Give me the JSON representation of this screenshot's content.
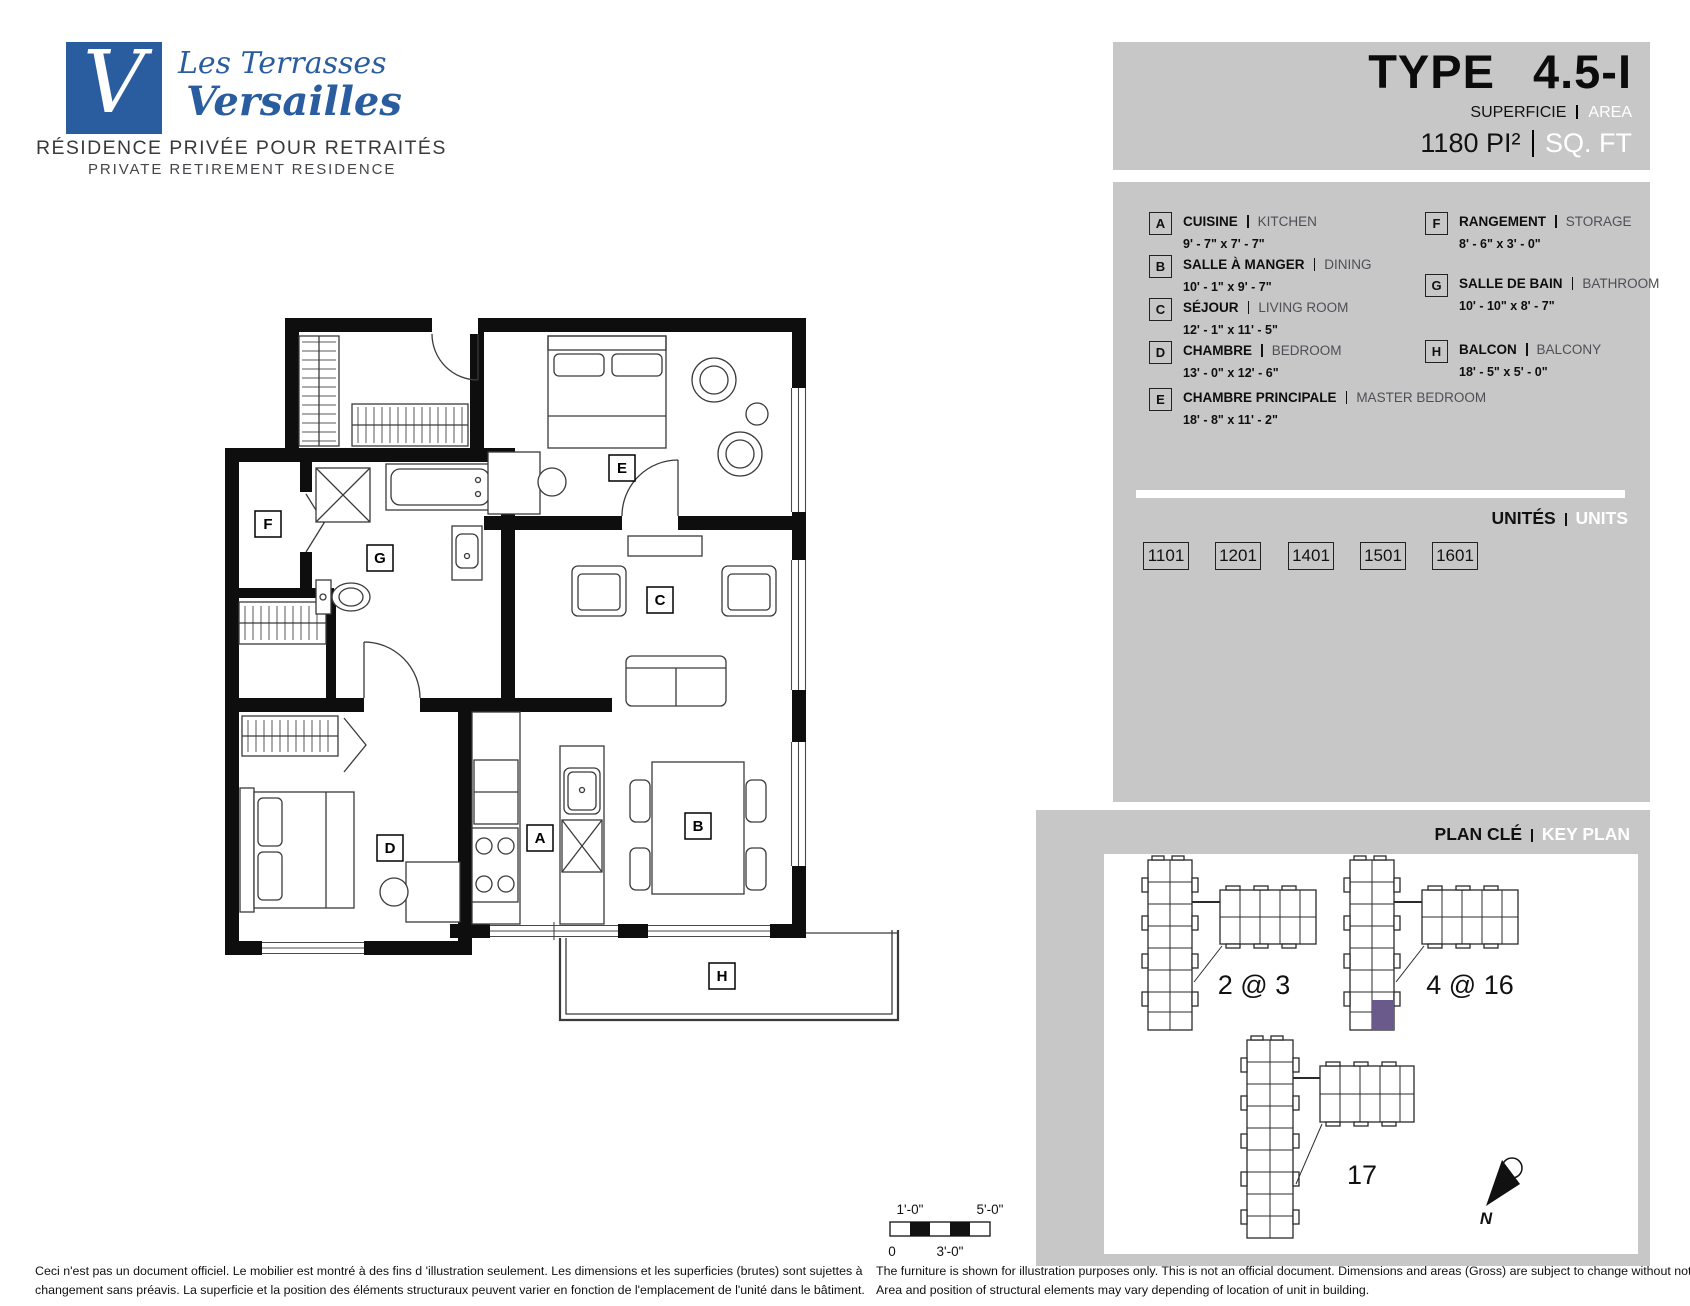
{
  "brand": {
    "monogram": "V",
    "name_line1": "Les Terrasses",
    "name_line2": "Versailles",
    "tagline_fr": "RÉSIDENCE PRIVÉE POUR RETRAITÉS",
    "tagline_en": "PRIVATE RETIREMENT RESIDENCE"
  },
  "header": {
    "type_label": "TYPE",
    "type_value": "4.5-I",
    "area_label_fr": "SUPERFICIE",
    "area_label_en": "AREA",
    "area_value": "1180 PI²",
    "area_unit_en": "SQ. FT"
  },
  "legend": {
    "items": [
      {
        "key": "A",
        "fr": "CUISINE",
        "en": "KITCHEN",
        "dims": "9' - 7\" x 7' - 7\""
      },
      {
        "key": "B",
        "fr": "SALLE À MANGER",
        "en": "DINING",
        "dims": "10' - 1\" x 9' - 7\""
      },
      {
        "key": "C",
        "fr": "SÉJOUR",
        "en": "LIVING ROOM",
        "dims": "12' - 1\" x 11' - 5\""
      },
      {
        "key": "D",
        "fr": "CHAMBRE",
        "en": "BEDROOM",
        "dims": "13' - 0\" x 12' - 6\""
      },
      {
        "key": "E",
        "fr": "CHAMBRE PRINCIPALE",
        "en": "MASTER BEDROOM",
        "dims": "18' - 8\" x 11' - 2\""
      },
      {
        "key": "F",
        "fr": "RANGEMENT",
        "en": "STORAGE",
        "dims": "8' - 6\" x 3' - 0\""
      },
      {
        "key": "G",
        "fr": "SALLE DE BAIN",
        "en": "BATHROOM",
        "dims": "10' - 10\" x 8' - 7\""
      },
      {
        "key": "H",
        "fr": "BALCON",
        "en": "BALCONY",
        "dims": "18' - 5\" x 5' - 0\""
      }
    ]
  },
  "units": {
    "label_fr": "UNITÉS",
    "label_en": "UNITS",
    "numbers": [
      "1101",
      "1201",
      "1401",
      "1501",
      "1601"
    ]
  },
  "key_plan": {
    "label_fr": "PLAN CLÉ",
    "label_en": "KEY PLAN",
    "building_labels": [
      "2 @ 3",
      "4 @ 16",
      "17"
    ],
    "north_label": "N",
    "highlight_color": "#6a5a8c"
  },
  "floor_plan": {
    "room_labels": {
      "A": "A",
      "B": "B",
      "C": "C",
      "D": "D",
      "E": "E",
      "F": "F",
      "G": "G",
      "H": "H"
    },
    "scale_bar": {
      "mark_1ft": "1'-0\"",
      "mark_5ft": "5'-0\"",
      "mark_0": "0",
      "mark_3ft": "3'-0\""
    }
  },
  "footer": {
    "disclaimer_fr_line1": "Ceci n'est pas un document officiel.  Le mobilier est montré à des fins d 'illustration seulement.  Les dimensions et les superficies (brutes) sont sujettes à",
    "disclaimer_fr_line2": "changement sans préavis. La superficie et la position des éléments structuraux peuvent varier en fonction de l'emplacement de l'unité dans le bâtiment.",
    "disclaimer_en_line1": "The furniture is shown for illustration purposes only.  This is not an official document.  Dimensions and areas (Gross) are subject to change without notice.",
    "disclaimer_en_line2": "Area and position of structural elements may vary depending of location of unit in building."
  },
  "colors": {
    "panel_gray": "#c7c7c7",
    "brand_blue": "#2a5d9f",
    "highlight_purple": "#6a5a8c"
  }
}
